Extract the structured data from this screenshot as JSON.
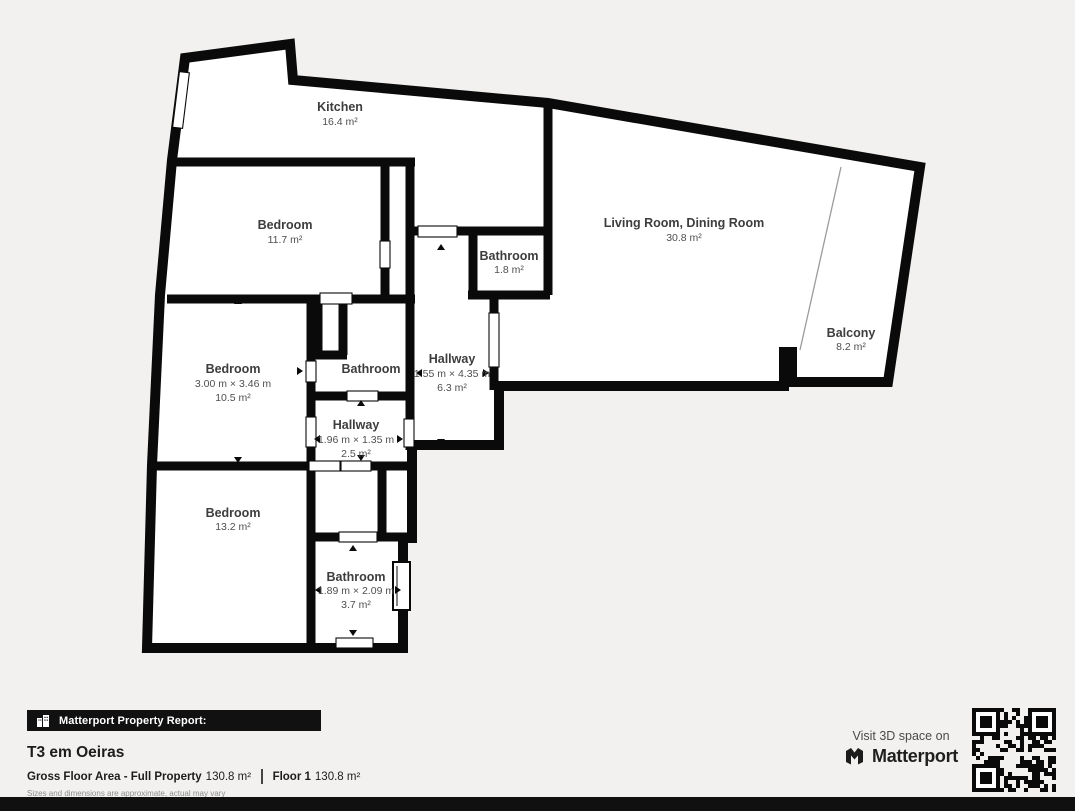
{
  "plan": {
    "rooms": [
      {
        "id": "kitchen",
        "name": "Kitchen",
        "area": "16.4 m²"
      },
      {
        "id": "bedroom-top",
        "name": "Bedroom",
        "area": "11.7 m²"
      },
      {
        "id": "bathroom-small",
        "name": "Bathroom",
        "area": "1.8 m²"
      },
      {
        "id": "living-dining",
        "name": "Living Room, Dining Room",
        "area": "30.8 m²"
      },
      {
        "id": "balcony",
        "name": "Balcony",
        "area": "8.2 m²"
      },
      {
        "id": "bedroom-middle",
        "name": "Bedroom",
        "dims": "3.00 m × 3.46 m",
        "area": "10.5 m²"
      },
      {
        "id": "bathroom-middle",
        "name": "Bathroom"
      },
      {
        "id": "hallway-long",
        "name": "Hallway",
        "dims": "1.55 m × 4.35 m",
        "area": "6.3 m²"
      },
      {
        "id": "hallway-small",
        "name": "Hallway",
        "dims": "1.96 m × 1.35 m",
        "area": "2.5 m²"
      },
      {
        "id": "bedroom-bottom",
        "name": "Bedroom",
        "area": "13.2 m²"
      },
      {
        "id": "bathroom-bottom",
        "name": "Bathroom",
        "dims": "1.89 m × 2.09 m",
        "area": "3.7 m²"
      }
    ]
  },
  "footer": {
    "report_label": "Matterport Property Report:",
    "property_title": "T3 em Oeiras",
    "gross_label": "Gross Floor Area - Full Property",
    "gross_value": "130.8 m²",
    "floor_label": "Floor 1",
    "floor_value": "130.8 m²",
    "disclaimer": "Sizes and dimensions are approximate, actual may vary"
  },
  "visit": {
    "line": "Visit 3D space on",
    "brand": "Matterport"
  },
  "colors": {
    "wall": "#0a0a0a",
    "floor": "#ffffff",
    "background": "#f2f1ef",
    "label": "#3d3d3d"
  }
}
